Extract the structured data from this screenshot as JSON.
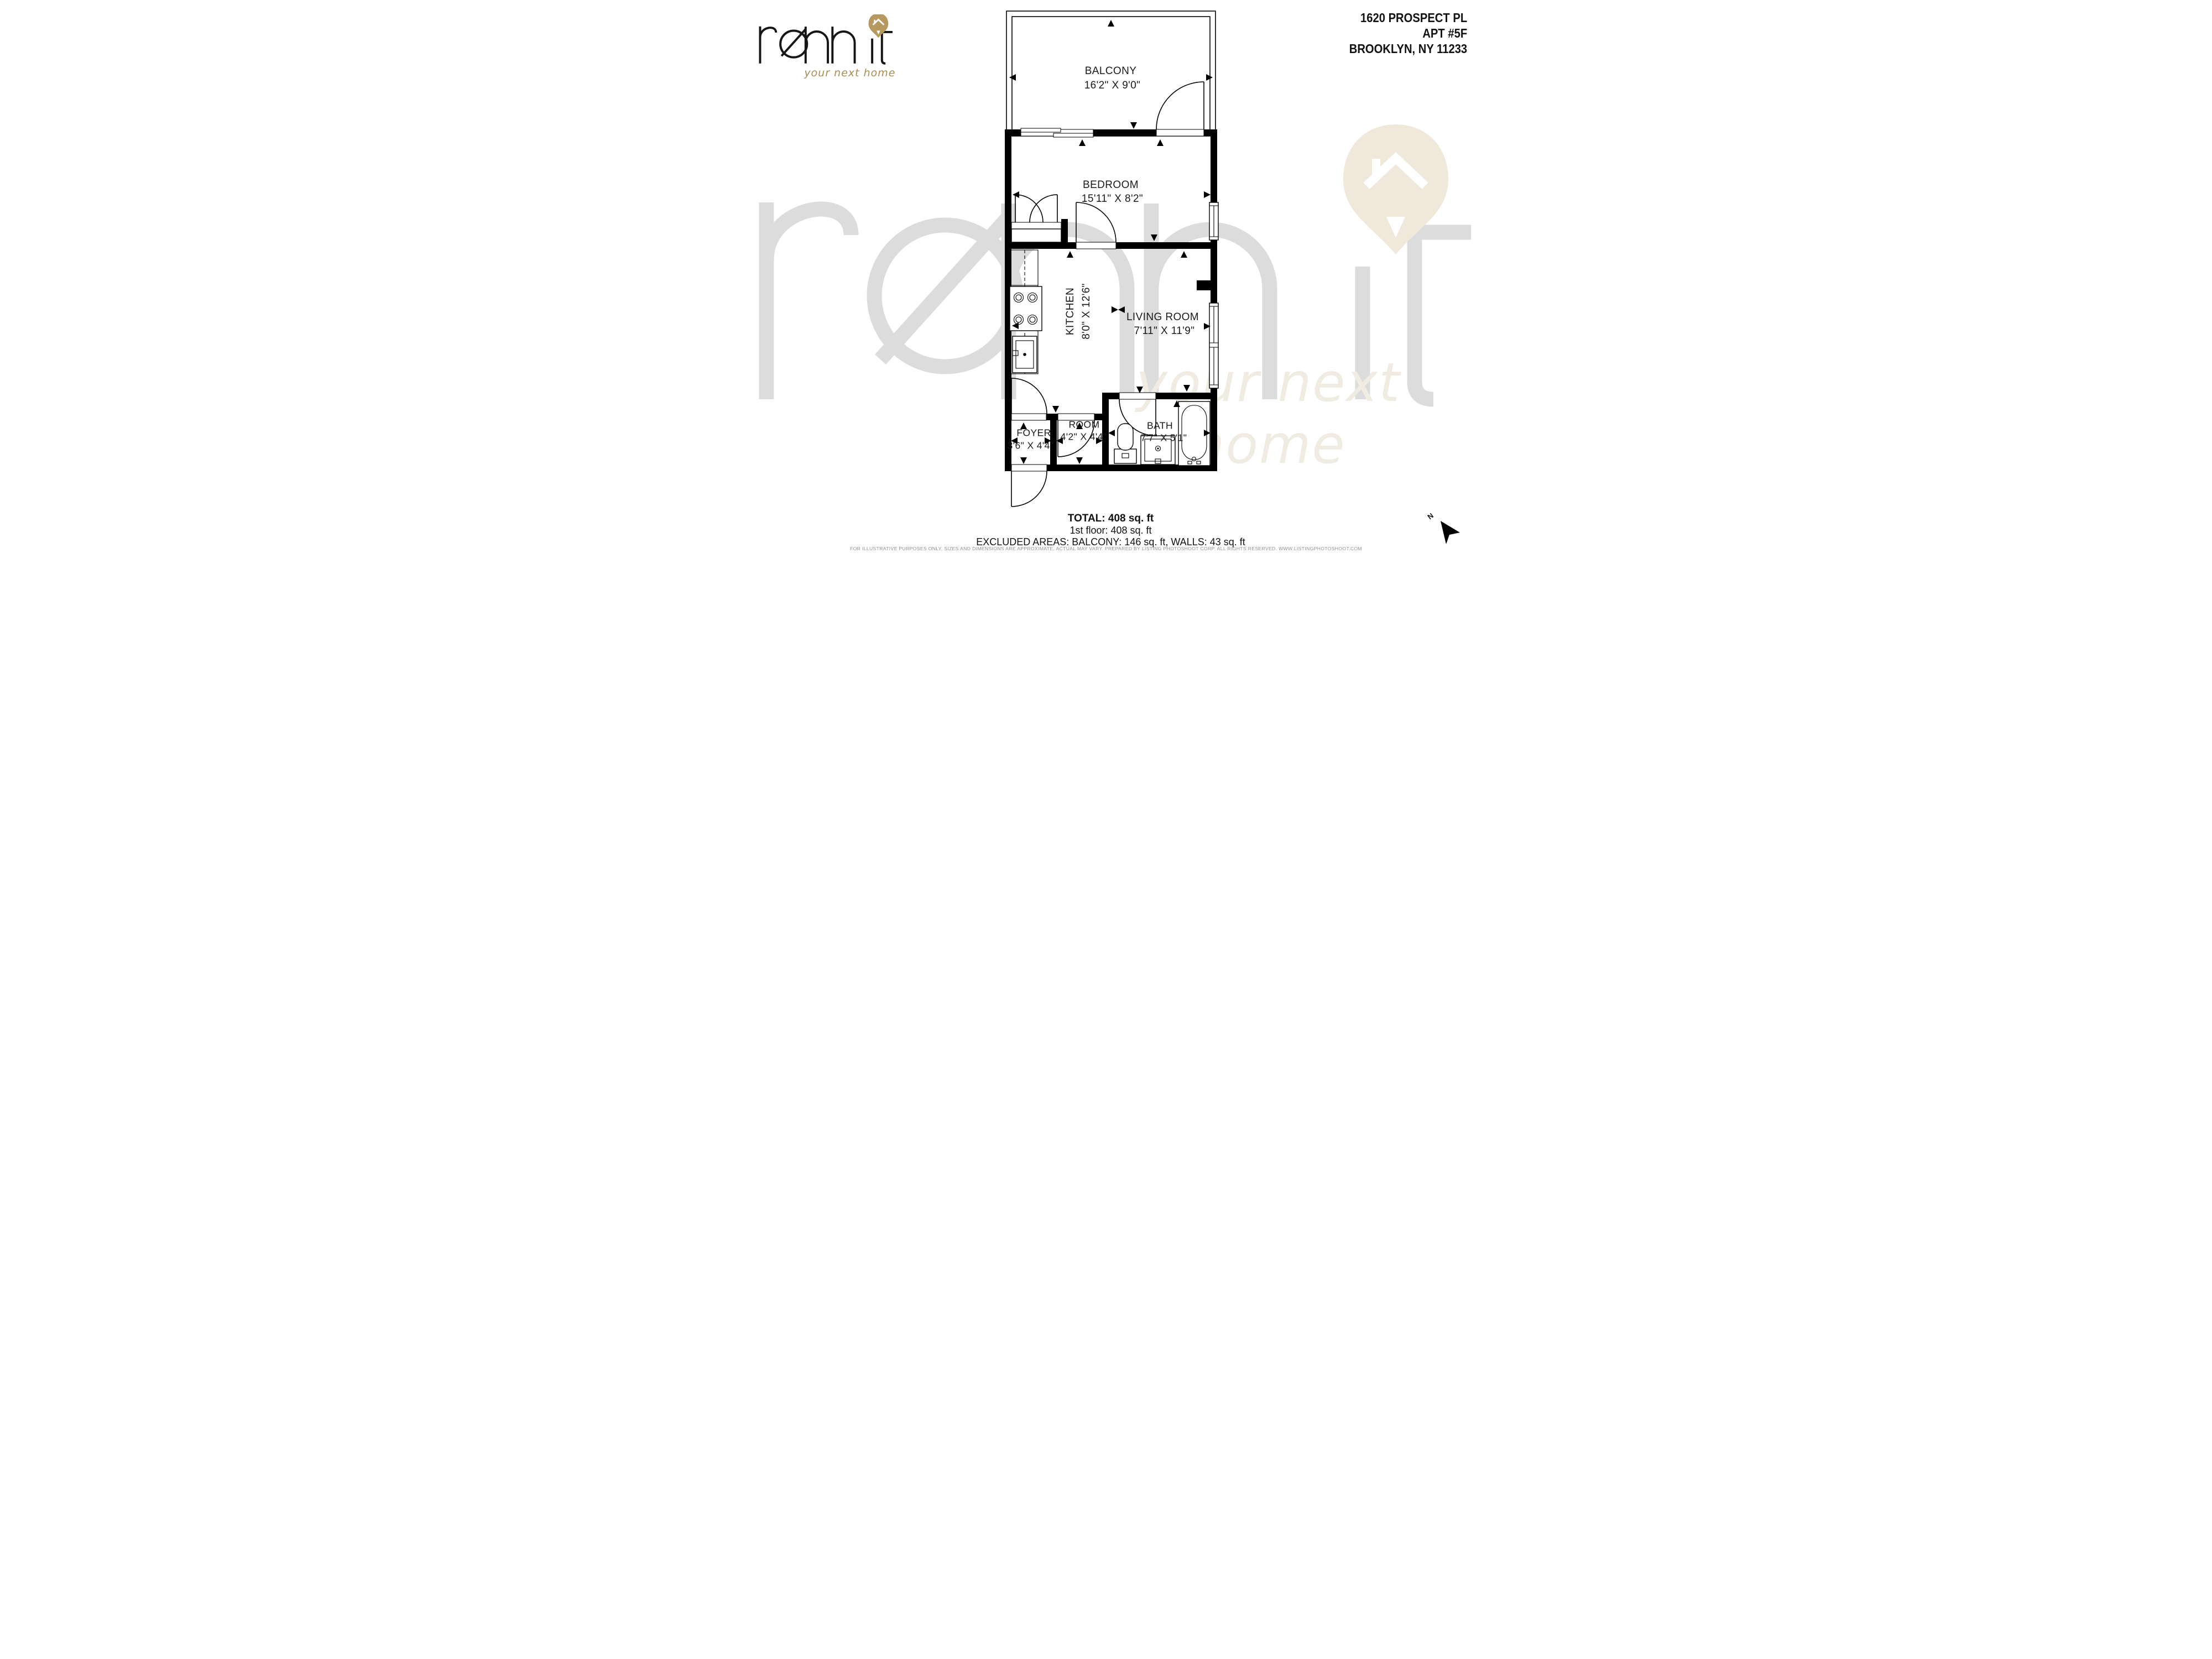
{
  "header": {
    "logo": {
      "brand": "rennit",
      "tagline": "your next home"
    },
    "address": {
      "line1": "1620 PROSPECT PL",
      "line2": "APT #5F",
      "line3": "BROOKLYN, NY  11233"
    }
  },
  "watermark": {
    "brand": "rennit",
    "tagline": "your next home"
  },
  "floorplan": {
    "rooms": [
      {
        "name": "BALCONY",
        "dim": "16'2\" X 9'0\""
      },
      {
        "name": "BEDROOM",
        "dim": "15'11\" X 8'2\""
      },
      {
        "name": "KITCHEN",
        "dim": "8'0\" X 12'6\""
      },
      {
        "name": "LIVING ROOM",
        "dim": "7'11\" X 11'9\""
      },
      {
        "name": "FOYER",
        "dim": "3'6\" X 4'4\""
      },
      {
        "name": "ROOM",
        "dim": "4'2\" X 4'4\""
      },
      {
        "name": "BATH",
        "dim": "7'7\" X 5'1\""
      }
    ]
  },
  "summary": {
    "total": "TOTAL: 408 sq. ft",
    "floor1": "1st floor: 408 sq. ft",
    "excluded": "EXCLUDED AREAS: BALCONY: 146 sq. ft, WALLS: 43 sq. ft"
  },
  "footer": {
    "disclaimer": "FOR ILLUSTRATIVE PURPOSES ONLY. SIZES AND DIMENSIONS ARE APPROXIMATE, ACTUAL MAY VARY. PREPARED BY LISTING PHOTOSHOOT CORP. ALL RIGHTS RESERVED. WWW.LISTINGPHOTOSHOOT.COM"
  },
  "compass": {
    "label": "N"
  },
  "colors": {
    "gold": "#b5995f",
    "watermark_gray": "#dcdcdc",
    "watermark_beige": "#efe8db",
    "line": "#000000"
  }
}
